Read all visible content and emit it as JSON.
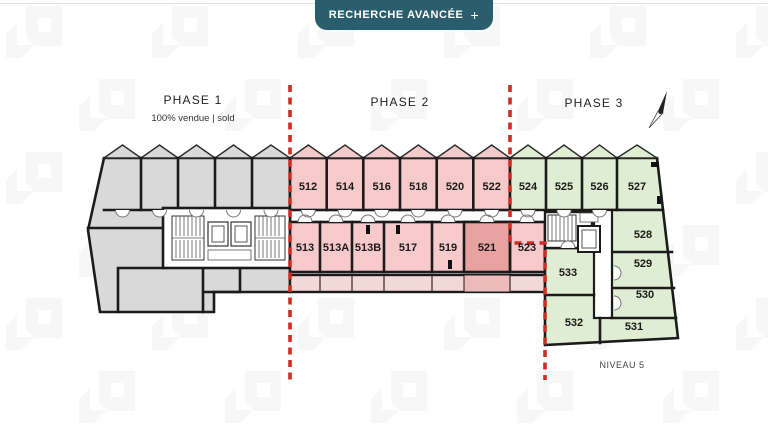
{
  "header": {
    "advanced_search_label": "RECHERCHE AVANCÉE",
    "advanced_search_plus": "+"
  },
  "plan": {
    "level_label": "NIVEAU 5",
    "phase1": {
      "label": "PHASE 1",
      "status": "100% vendue | sold"
    },
    "phase2": {
      "label": "PHASE 2"
    },
    "phase3": {
      "label": "PHASE 3"
    },
    "units": {
      "phase2_top": [
        "512",
        "514",
        "516",
        "518",
        "520",
        "522"
      ],
      "phase3_top": [
        "524",
        "525",
        "526",
        "527"
      ],
      "phase2_mid": [
        "513",
        "513A",
        "513B",
        "517",
        "519",
        "521",
        "523"
      ],
      "phase3_units": [
        "528",
        "529",
        "530",
        "531",
        "532",
        "533"
      ]
    },
    "highlighted_unit": "521",
    "colors": {
      "phase1_fill": "#d9d9d9",
      "phase2_fill": "#f6caca",
      "phase2_corridor": "#f2d8d6",
      "highlight_fill": "#e8a3a1",
      "highlight_corridor": "#ecbab8",
      "phase3_fill": "#dfeed2",
      "boundary_dash": "#d02c24",
      "header_teal": "#2a5e6c",
      "watermark": "#f7f7f7"
    }
  }
}
